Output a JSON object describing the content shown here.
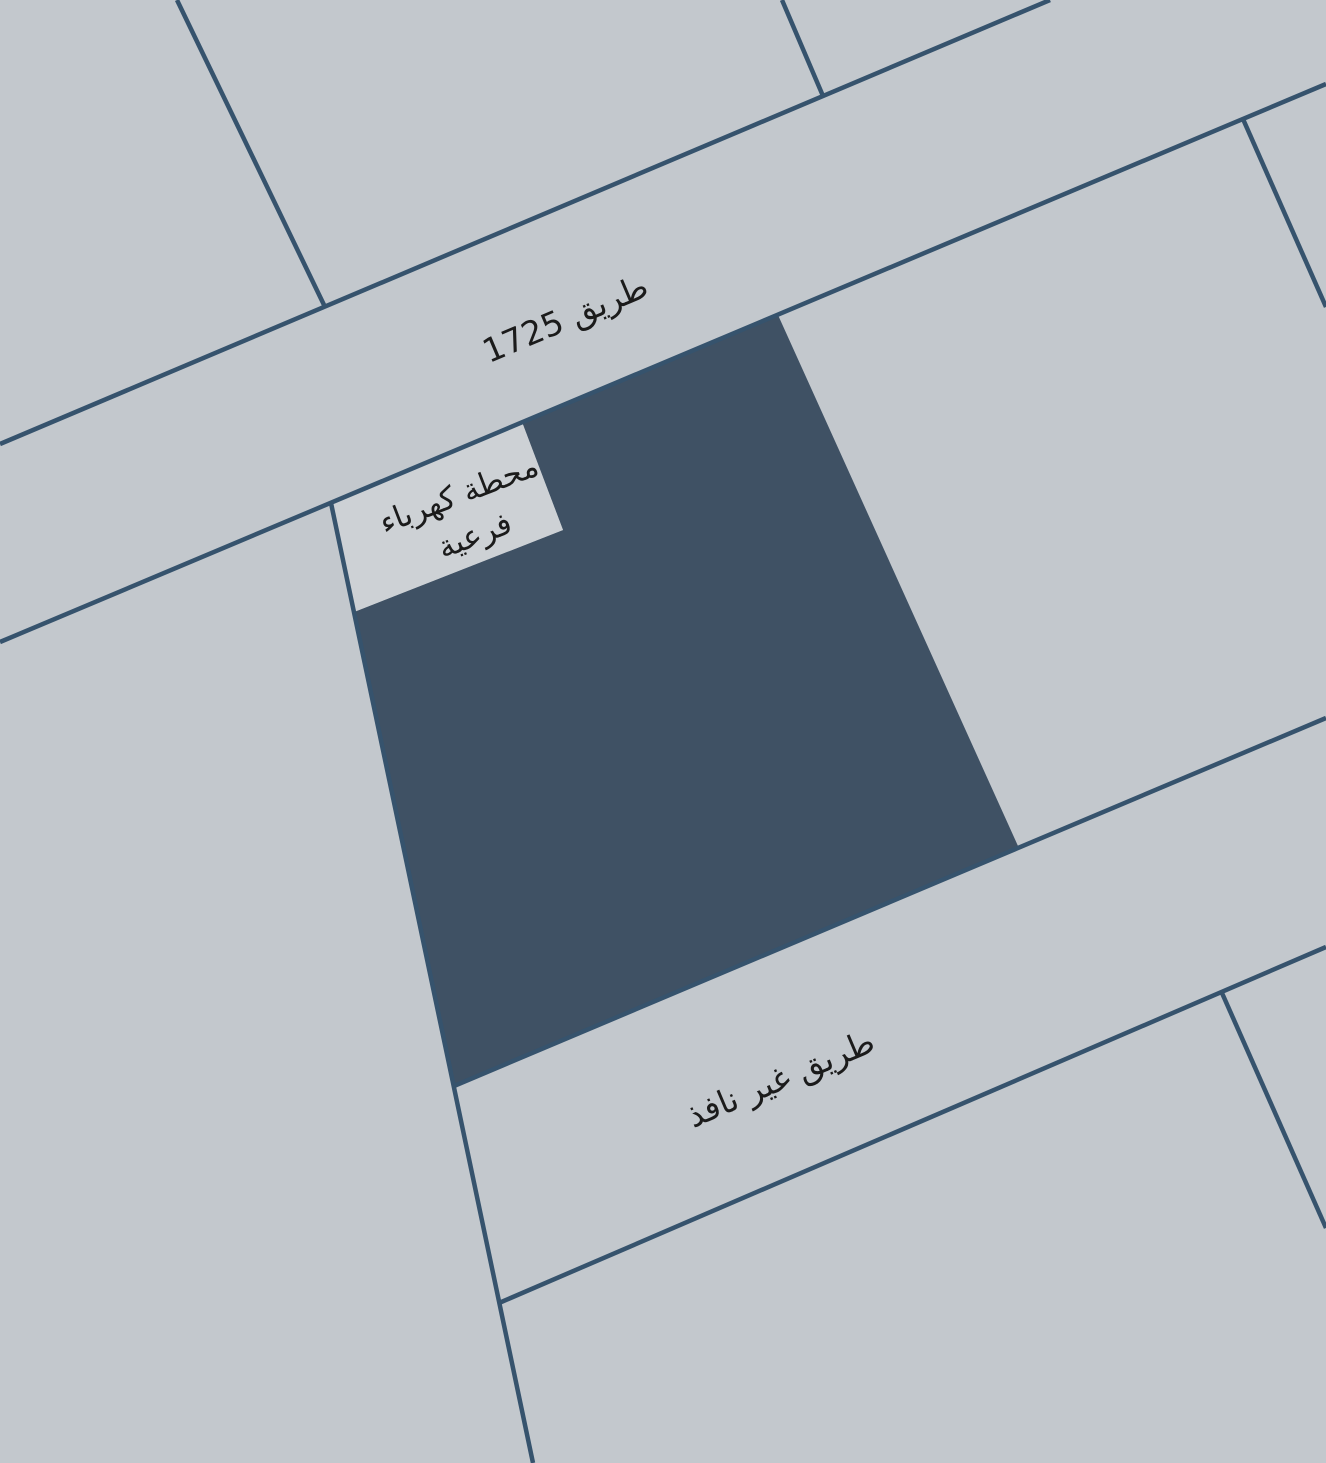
{
  "map": {
    "labels": {
      "road_main": "طريق 1725",
      "substation_line1": "محطة كهرباء",
      "substation_line2": "فرعية",
      "road_dead_end": "طريق غير نافذ"
    },
    "colors": {
      "background": "#c3c8cd",
      "parcel_highlight": "#3f5164",
      "parcel_substation": "#cdd1d5",
      "boundary_line": "#36536d",
      "label_text": "#1b1b1b"
    }
  }
}
